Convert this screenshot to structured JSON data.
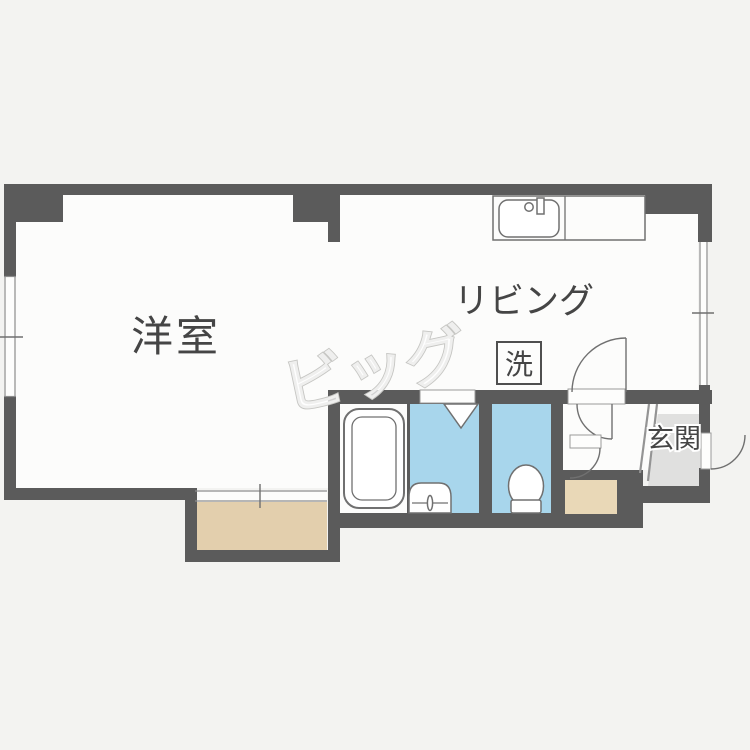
{
  "document": {
    "type": "real-estate-floor-plan"
  },
  "labels": {
    "western_room": "洋室",
    "living": "リビング",
    "laundry": "洗",
    "entrance": "玄関"
  },
  "watermark": {
    "text": "ビッグ"
  },
  "colors": {
    "wall": "#5b5b5b",
    "floor": "#fcfcfb",
    "wet": "#a8d6ec",
    "balcony": "#e3cfad",
    "shoe": "#e9d8b7",
    "genkan": "#e0e0df",
    "outside": "#f3f3f1",
    "line": "#707070",
    "text": "#454545"
  }
}
